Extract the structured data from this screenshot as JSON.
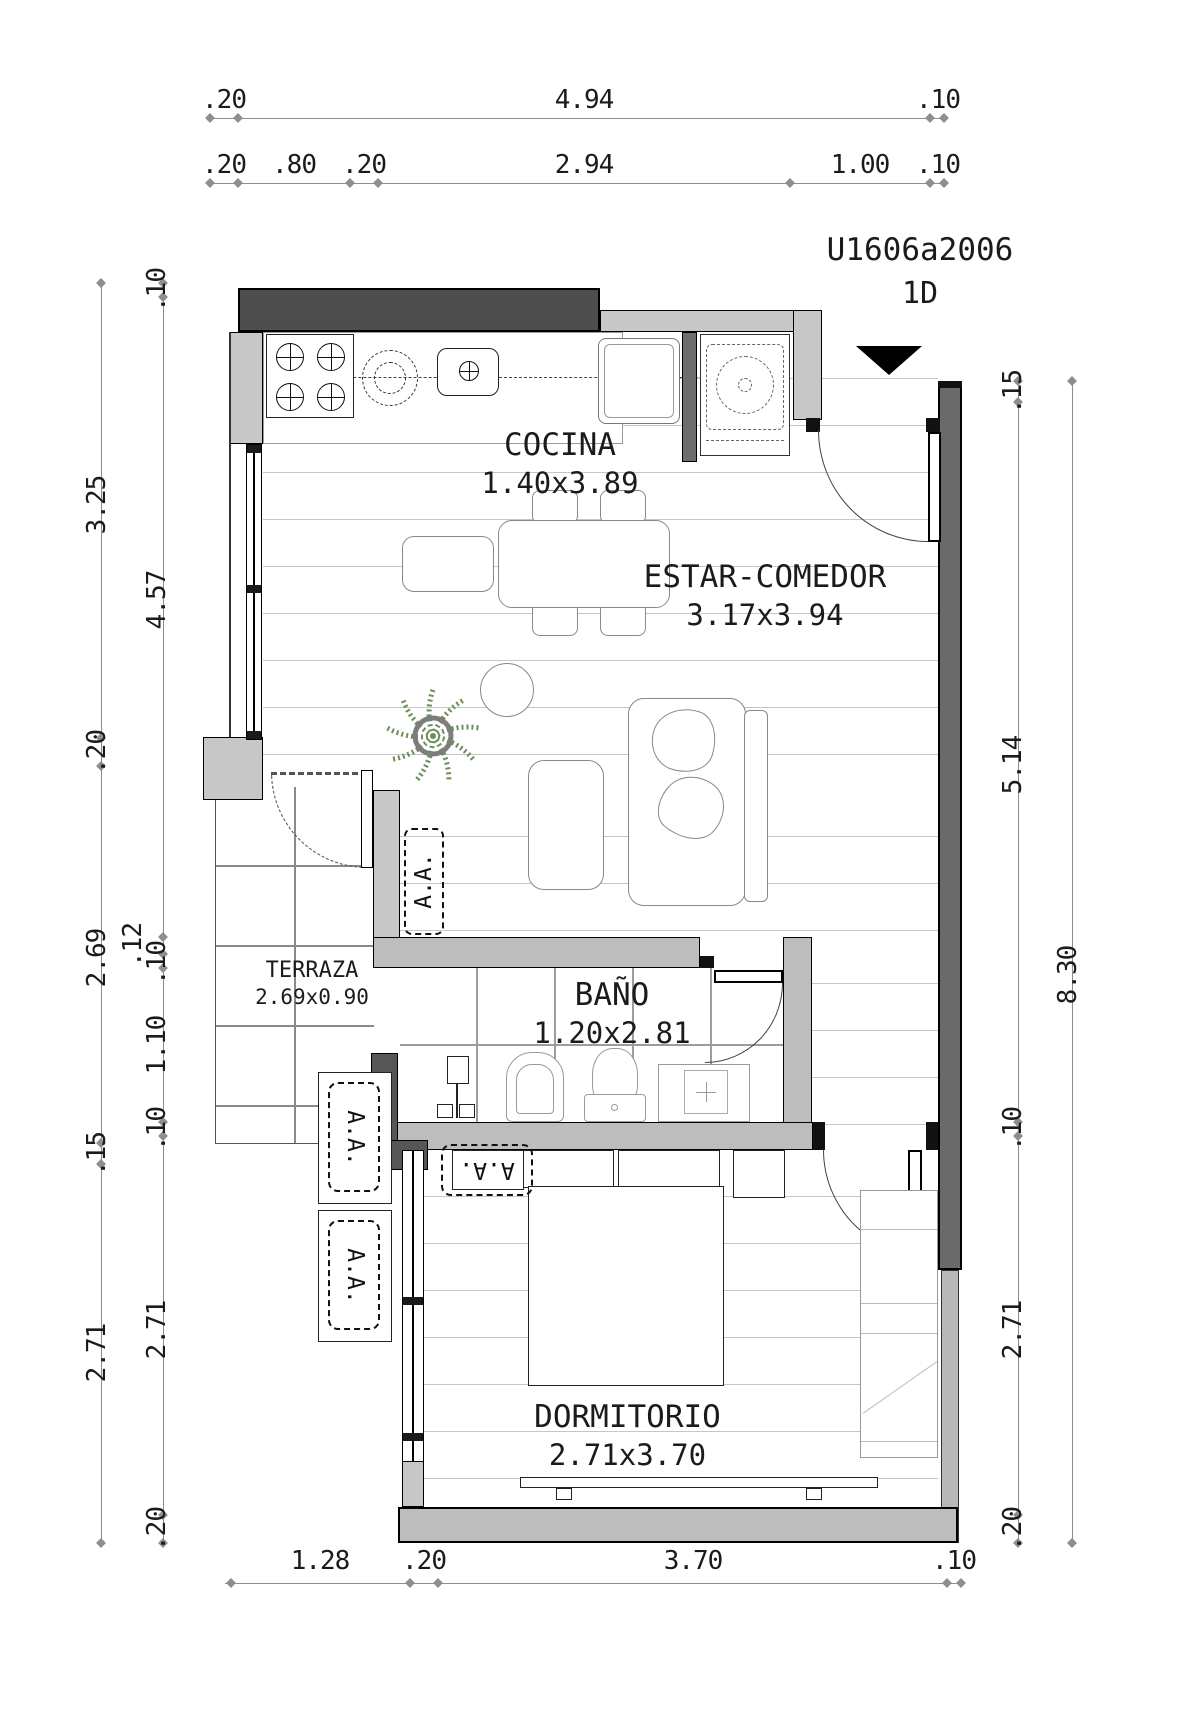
{
  "title": {
    "unit_code": "U1606a2006",
    "unit_type": "1D"
  },
  "rooms": [
    {
      "name": "COCINA",
      "dimensions": "1.40x3.89"
    },
    {
      "name": "ESTAR-COMEDOR",
      "dimensions": "3.17x3.94"
    },
    {
      "name": "TERRAZA",
      "dimensions": "2.69x0.90"
    },
    {
      "name": "BAÑO",
      "dimensions": "1.20x2.81"
    },
    {
      "name": "DORMITORIO",
      "dimensions": "2.71x3.70"
    }
  ],
  "ac_unit_label": "A.A.",
  "dimension_chains": {
    "top_overall": [
      ".20",
      "4.94",
      ".10"
    ],
    "top_detail": [
      ".20",
      ".80",
      ".20",
      "2.94",
      "1.00",
      ".10"
    ],
    "left_outer": [
      "3.25",
      ".20",
      "2.69",
      ".15",
      "2.71"
    ],
    "left_inner": [
      ".10",
      "4.57",
      ".12",
      ".10",
      "1.10",
      ".10",
      "2.71",
      ".20"
    ],
    "right_outer": [
      "8.30"
    ],
    "right_inner": [
      ".15",
      "5.14",
      ".10",
      "2.71",
      ".20"
    ],
    "bottom": [
      "1.28",
      ".20",
      "3.70",
      ".10"
    ]
  },
  "colors": {
    "wall_dark": "#4e4e4e",
    "wall_medium": "#6e6e6e",
    "wall_light": "#c7c7c7",
    "wall_bath": "#bdbdbd",
    "dimension_line": "#8c8c8c",
    "plant_green": "#6d8f58"
  }
}
